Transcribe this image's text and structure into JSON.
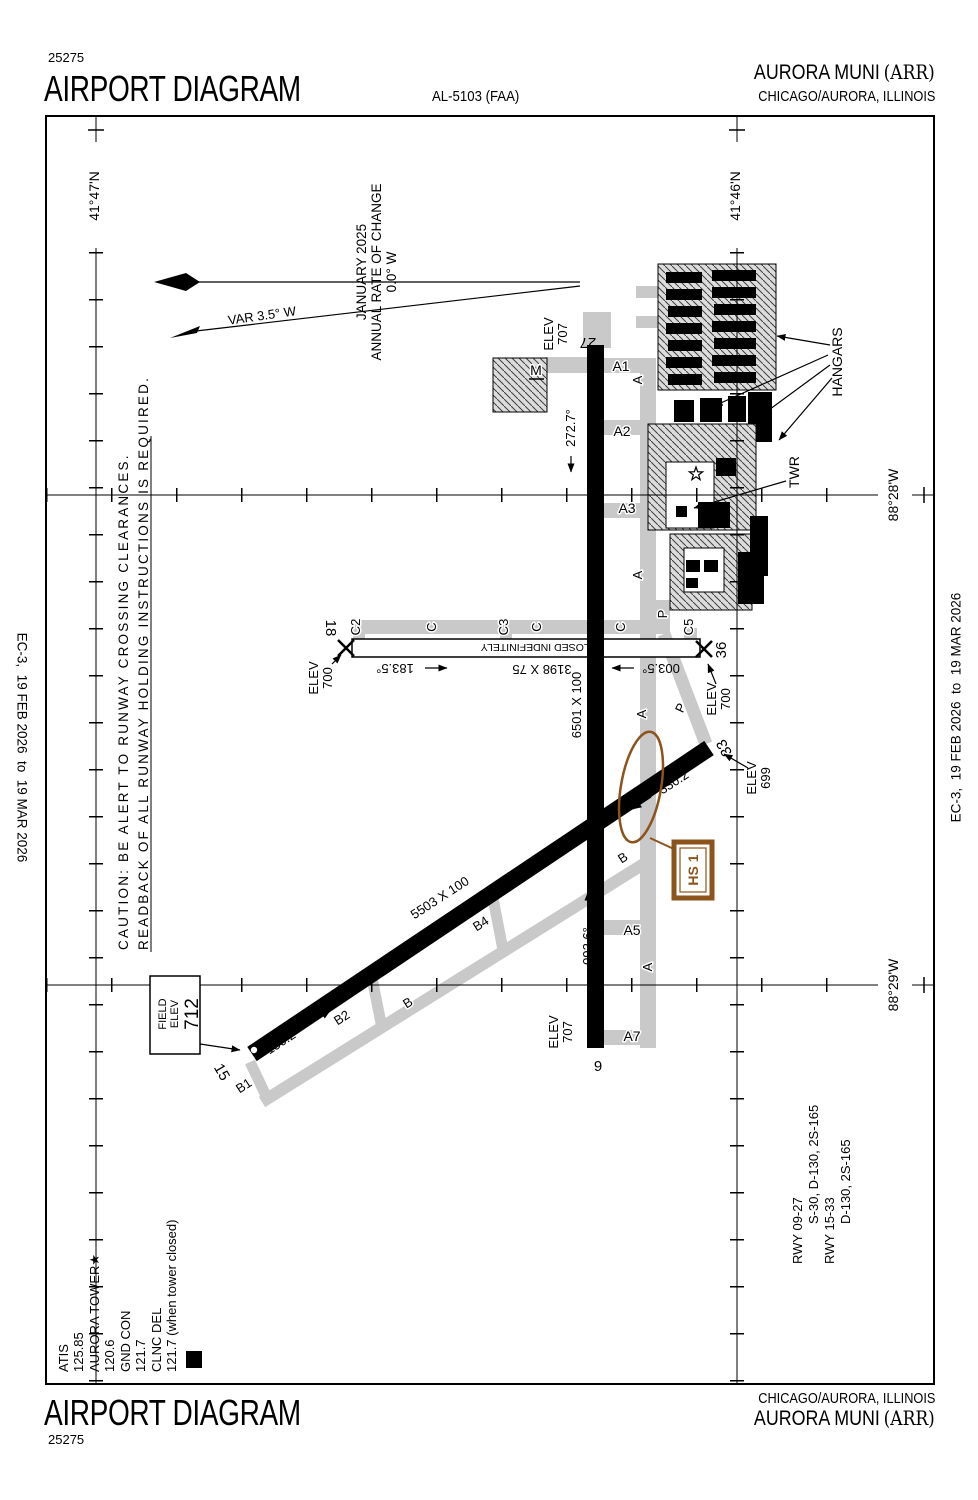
{
  "header": {
    "chart_number": "25275",
    "title": "AIRPORT DIAGRAM",
    "procedure_id": "AL-5103 (FAA)",
    "airport_name": "AURORA MUNI",
    "airport_id": "(ARR)",
    "city": "CHICAGO/AURORA, ILLINOIS"
  },
  "footer": {
    "chart_number": "25275",
    "title": "AIRPORT DIAGRAM",
    "airport_name": "AURORA MUNI",
    "airport_id": "(ARR)",
    "city": "CHICAGO/AURORA, ILLINOIS"
  },
  "margin": {
    "effective_dates": "EC-3,  19 FEB 2026  to  19 MAR 2026"
  },
  "frequencies": {
    "atis_label": "ATIS",
    "atis": "125.85",
    "twr_label": "AURORA TOWER★",
    "twr": "120.6",
    "gnd_label": "GND CON",
    "gnd": "121.7",
    "clnc_label": "CLNC DEL",
    "clnc": "121.7 (when tower closed)",
    "d_symbol": "D"
  },
  "caution": {
    "line1": "CAUTION: BE ALERT TO RUNWAY CROSSING CLEARANCES.",
    "line2": "READBACK OF ALL RUNWAY HOLDING INSTRUCTIONS IS REQUIRED."
  },
  "compass": {
    "var_label": "VAR 3.5° W",
    "date": "JANUARY 2025",
    "rate": "ANNUAL RATE OF CHANGE",
    "rate_value": "0.0° W"
  },
  "grid": {
    "lat_left": "41°47'N",
    "lat_right": "41°46'N",
    "lon_upper": "88°28'W",
    "lon_lower": "88°29'W"
  },
  "field_elev": {
    "l1": "FIELD",
    "l2": "ELEV",
    "value": "712"
  },
  "runways": {
    "r0927": {
      "num27": "27",
      "num9": "9",
      "hdg27": "272.7°",
      "hdg9": "092.6°",
      "dim": "6501 X 100"
    },
    "r1533": {
      "num15": "15",
      "num33": "33",
      "hdg15": "150.2°",
      "hdg33": "330.2°",
      "dim": "5503 X 100"
    },
    "r1836": {
      "num18": "18",
      "num36": "36",
      "hdg18": "183.5°",
      "hdg36": "003.5°",
      "dim": "3198 X 75",
      "status": "CLOSED INDEFINITELY"
    }
  },
  "elevations": {
    "label": "ELEV",
    "e707": "707",
    "e700": "700",
    "e699": "699"
  },
  "taxiways": {
    "a": "A",
    "a1": "A1",
    "a2": "A2",
    "a3": "A3",
    "a5": "A5",
    "a7": "A7",
    "b": "B",
    "b1": "B1",
    "b2": "B2",
    "b4": "B4",
    "c": "C",
    "c2": "C2",
    "c3": "C3",
    "c5": "C5",
    "m": "M",
    "p": "P"
  },
  "buildings": {
    "hangars": "HANGARS",
    "tower": "TWR"
  },
  "hotspot": {
    "label": "HS 1"
  },
  "runway_data": {
    "l1": "RWY 09-27",
    "l2": "S-30, D-130, 2S-165",
    "l3": "RWY 15-33",
    "l4": "D-130, 2S-165"
  },
  "colors": {
    "hotspot_brown": "#8C531B",
    "taxiway_gray": "#C9C9C9",
    "apron_gray": "#DCDCDC"
  }
}
